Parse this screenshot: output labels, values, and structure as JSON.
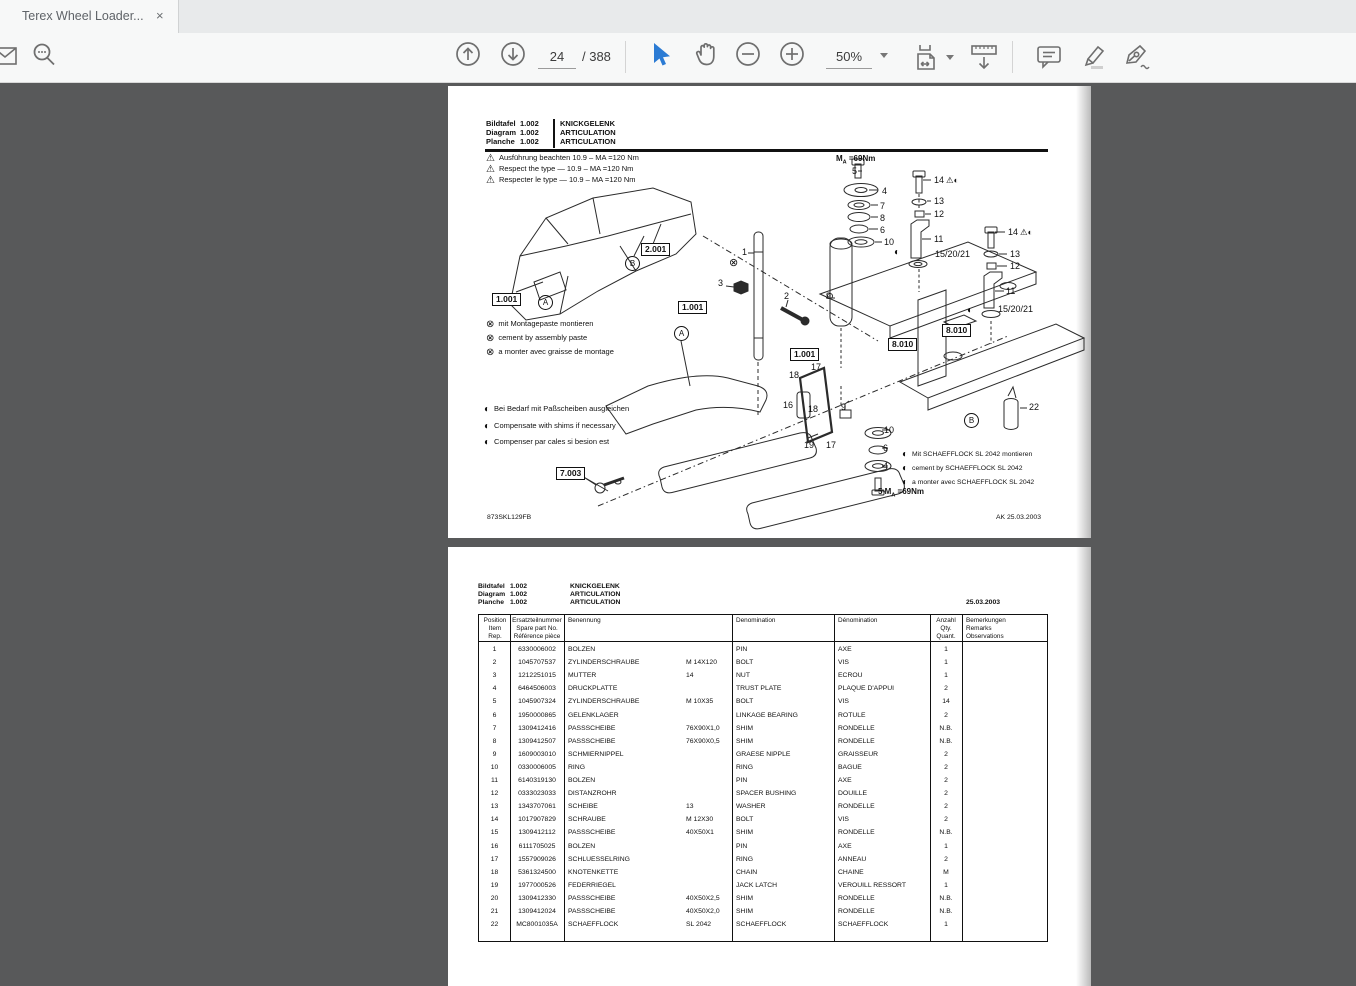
{
  "browser": {
    "tab_title": "Terex Wheel Loader...",
    "close_glyph": "×"
  },
  "toolbar": {
    "page_current": "24",
    "page_total": "/ 388",
    "zoom_level": "50%",
    "accent_blue": "#2b7bd4"
  },
  "page1": {
    "header": {
      "labels": [
        "Bildtafel",
        "Diagram",
        "Planche"
      ],
      "numbers": [
        "1.002",
        "1.002",
        "1.002"
      ],
      "titles": [
        "KNICKGELENK",
        "ARTICULATION",
        "ARTICULATION"
      ]
    },
    "warnings": [
      "Ausführung beachten 10.9  –  MA =120 Nm",
      "Respect the type — 10.9  –  MA =120 Nm",
      "Respecter le type — 10.9  –  MA =120 Nm"
    ],
    "x_notes": [
      "mit Montagepaste montieren",
      "cement by assembly paste",
      "a monter avec graisse de montage"
    ],
    "shim_notes": [
      "Bei Bedarf mit Paßscheiben ausgleichen",
      "Compensate with shims if necessary",
      "Compenser par cales si besion est"
    ],
    "glue_notes": [
      "Mit SCHAEFFLOCK SL 2042 montieren",
      "cement by SCHAEFFLOCK SL 2042",
      "a monter avec SCHAEFFLOCK SL 2042"
    ],
    "torque_top": {
      "pre": "M",
      "sub": "A",
      "val": " =69Nm"
    },
    "torque_bottom": {
      "pre": "5 M",
      "sub": "A",
      "val": " =69Nm"
    },
    "doc_code": "873SKL129FB",
    "date_code": "AK  25.03.2003",
    "diagram": {
      "labels": [
        {
          "k": "box",
          "t": "1.001",
          "x": 44,
          "y": 207
        },
        {
          "k": "box",
          "t": "2.001",
          "x": 193,
          "y": 157
        },
        {
          "k": "box",
          "t": "1.001",
          "x": 230,
          "y": 215
        },
        {
          "k": "box",
          "t": "1.001",
          "x": 342,
          "y": 262
        },
        {
          "k": "box",
          "t": "8.010",
          "x": 440,
          "y": 252
        },
        {
          "k": "box",
          "t": "8.010",
          "x": 494,
          "y": 238
        },
        {
          "k": "box",
          "t": "7.003",
          "x": 108,
          "y": 381
        },
        {
          "k": "circ",
          "t": "A",
          "x": 90,
          "y": 209
        },
        {
          "k": "circ",
          "t": "B",
          "x": 177,
          "y": 170
        },
        {
          "k": "circ",
          "t": "A",
          "x": 226,
          "y": 240
        },
        {
          "k": "circ",
          "t": "B",
          "x": 516,
          "y": 327
        },
        {
          "k": "xm",
          "t": "⊗",
          "x": 281,
          "y": 172
        },
        {
          "k": "half",
          "t": "◐",
          "x": 446,
          "y": 162
        },
        {
          "k": "half",
          "t": "◐",
          "x": 519,
          "y": 220
        },
        {
          "k": "num",
          "t": "1",
          "x": 294,
          "y": 162
        },
        {
          "k": "num",
          "t": "3",
          "x": 270,
          "y": 193
        },
        {
          "k": "num",
          "t": "2",
          "x": 336,
          "y": 206
        },
        {
          "k": "num",
          "t": "9",
          "x": 378,
          "y": 206
        },
        {
          "k": "num",
          "t": "9",
          "x": 393,
          "y": 317
        },
        {
          "k": "num",
          "t": "18",
          "x": 341,
          "y": 285
        },
        {
          "k": "num",
          "t": "17",
          "x": 363,
          "y": 277
        },
        {
          "k": "num",
          "t": "16",
          "x": 335,
          "y": 315
        },
        {
          "k": "num",
          "t": "18",
          "x": 360,
          "y": 319
        },
        {
          "k": "num",
          "t": "19",
          "x": 356,
          "y": 355
        },
        {
          "k": "num",
          "t": "17",
          "x": 378,
          "y": 355
        },
        {
          "k": "num",
          "t": "10",
          "x": 436,
          "y": 340
        },
        {
          "k": "num",
          "t": "6",
          "x": 435,
          "y": 358
        },
        {
          "k": "num",
          "t": "4",
          "x": 435,
          "y": 376
        },
        {
          "k": "num",
          "t": "5",
          "x": 404,
          "y": 81
        },
        {
          "k": "num",
          "t": "4",
          "x": 434,
          "y": 101
        },
        {
          "k": "num",
          "t": "7",
          "x": 432,
          "y": 116
        },
        {
          "k": "num",
          "t": "8",
          "x": 432,
          "y": 128
        },
        {
          "k": "num",
          "t": "6",
          "x": 432,
          "y": 140
        },
        {
          "k": "num",
          "t": "10",
          "x": 436,
          "y": 152
        },
        {
          "k": "num",
          "t": "14",
          "x": 486,
          "y": 90,
          "warn": true
        },
        {
          "k": "num",
          "t": "13",
          "x": 486,
          "y": 111
        },
        {
          "k": "num",
          "t": "12",
          "x": 486,
          "y": 124
        },
        {
          "k": "num",
          "t": "11",
          "x": 486,
          "y": 149
        },
        {
          "k": "num",
          "t": "15/20/21",
          "x": 487,
          "y": 164
        },
        {
          "k": "num",
          "t": "14",
          "x": 560,
          "y": 142,
          "warn": true
        },
        {
          "k": "num",
          "t": "13",
          "x": 562,
          "y": 164
        },
        {
          "k": "num",
          "t": "12",
          "x": 562,
          "y": 176
        },
        {
          "k": "num",
          "t": "11",
          "x": 558,
          "y": 201
        },
        {
          "k": "num",
          "t": "15/20/21",
          "x": 550,
          "y": 219
        },
        {
          "k": "num",
          "t": "22",
          "x": 581,
          "y": 317
        }
      ]
    }
  },
  "page2": {
    "header": {
      "labels": [
        "Bildtafel",
        "Diagram",
        "Planche"
      ],
      "numbers": [
        "1.002",
        "1.002",
        "1.002"
      ],
      "titles": [
        "KNICKGELENK",
        "ARTICULATION",
        "ARTICULATION"
      ],
      "date": "25.03.2003"
    },
    "table": {
      "col_headers": [
        [
          "Position",
          "Item",
          "Rep."
        ],
        [
          "Ersatzteilnummer",
          "Spare part No.",
          "Référence pièce"
        ],
        [
          "Benennung",
          "",
          ""
        ],
        [
          "Denomination",
          "",
          ""
        ],
        [
          "Dénomination",
          "",
          ""
        ],
        [
          "Anzahl",
          "Qty.",
          "Quant."
        ],
        [
          "Bemerkungen",
          "Remarks",
          "Observations"
        ]
      ],
      "rows": [
        {
          "pos": "1",
          "part": "6330006002",
          "name": "BOLZEN",
          "size": "",
          "denom": "PIN",
          "denfr": "AXE",
          "qty": "1"
        },
        {
          "pos": "2",
          "part": "1045707537",
          "name": "ZYLINDERSCHRAUBE",
          "size": "M 14X120",
          "denom": "BOLT",
          "denfr": "VIS",
          "qty": "1"
        },
        {
          "pos": "3",
          "part": "1212251015",
          "name": "MUTTER",
          "size": "14",
          "denom": "NUT",
          "denfr": "ECROU",
          "qty": "1"
        },
        {
          "pos": "4",
          "part": "6464506003",
          "name": "DRUCKPLATTE",
          "size": "",
          "denom": "TRUST PLATE",
          "denfr": "PLAQUE D'APPUI",
          "qty": "2"
        },
        {
          "pos": "5",
          "part": "1045907324",
          "name": "ZYLINDERSCHRAUBE",
          "size": "M 10X35",
          "denom": "BOLT",
          "denfr": "VIS",
          "qty": "14"
        },
        {
          "pos": "6",
          "part": "1950000865",
          "name": "GELENKLAGER",
          "size": "",
          "denom": "LINKAGE BEARING",
          "denfr": "ROTULE",
          "qty": "2"
        },
        {
          "pos": "7",
          "part": "1309412416",
          "name": "PASSSCHEIBE",
          "size": "76X90X1,0",
          "denom": "SHIM",
          "denfr": "RONDELLE",
          "qty": "N.B."
        },
        {
          "pos": "8",
          "part": "1309412507",
          "name": "PASSSCHEIBE",
          "size": "76X90X0,5",
          "denom": "SHIM",
          "denfr": "RONDELLE",
          "qty": "N.B."
        },
        {
          "pos": "9",
          "part": "1609003010",
          "name": "SCHMIERNIPPEL",
          "size": "",
          "denom": "GRAESE NIPPLE",
          "denfr": "GRAISSEUR",
          "qty": "2"
        },
        {
          "pos": "10",
          "part": "0330006005",
          "name": "RING",
          "size": "",
          "denom": "RING",
          "denfr": "BAGUE",
          "qty": "2"
        },
        {
          "pos": "11",
          "part": "6140319130",
          "name": "BOLZEN",
          "size": "",
          "denom": "PIN",
          "denfr": "AXE",
          "qty": "2"
        },
        {
          "pos": "12",
          "part": "0333023033",
          "name": "DISTANZROHR",
          "size": "",
          "denom": "SPACER BUSHING",
          "denfr": "DOUILLE",
          "qty": "2"
        },
        {
          "pos": "13",
          "part": "1343707061",
          "name": "SCHEIBE",
          "size": "13",
          "denom": "WASHER",
          "denfr": "RONDELLE",
          "qty": "2"
        },
        {
          "pos": "14",
          "part": "1017907829",
          "name": "SCHRAUBE",
          "size": "M 12X30",
          "denom": "BOLT",
          "denfr": "VIS",
          "qty": "2"
        },
        {
          "pos": "15",
          "part": "1309412112",
          "name": "PASSSCHEIBE",
          "size": "40X50X1",
          "denom": "SHIM",
          "denfr": "RONDELLE",
          "qty": "N.B."
        },
        {
          "pos": "16",
          "part": "6111705025",
          "name": "BOLZEN",
          "size": "",
          "denom": "PIN",
          "denfr": "AXE",
          "qty": "1"
        },
        {
          "pos": "17",
          "part": "1557909026",
          "name": "SCHLUESSELRING",
          "size": "",
          "denom": "RING",
          "denfr": "ANNEAU",
          "qty": "2"
        },
        {
          "pos": "18",
          "part": "5361324500",
          "name": "KNOTENKETTE",
          "size": "",
          "denom": "CHAIN",
          "denfr": "CHAINE",
          "qty": "M"
        },
        {
          "pos": "19",
          "part": "1977000526",
          "name": "FEDERRIEGEL",
          "size": "",
          "denom": "JACK LATCH",
          "denfr": "VEROUILL RESSORT",
          "qty": "1"
        },
        {
          "pos": "20",
          "part": "1309412330",
          "name": "PASSSCHEIBE",
          "size": "40X50X2,5",
          "denom": "SHIM",
          "denfr": "RONDELLE",
          "qty": "N.B."
        },
        {
          "pos": "21",
          "part": "1309412024",
          "name": "PASSSCHEIBE",
          "size": "40X50X2,0",
          "denom": "SHIM",
          "denfr": "RONDELLE",
          "qty": "N.B."
        },
        {
          "pos": "22",
          "part": "MC8001035A",
          "name": "SCHAEFFLOCK",
          "size": "SL 2042",
          "denom": "SCHAEFFLOCK",
          "denfr": "SCHAEFFLOCK",
          "qty": "1"
        }
      ]
    }
  }
}
